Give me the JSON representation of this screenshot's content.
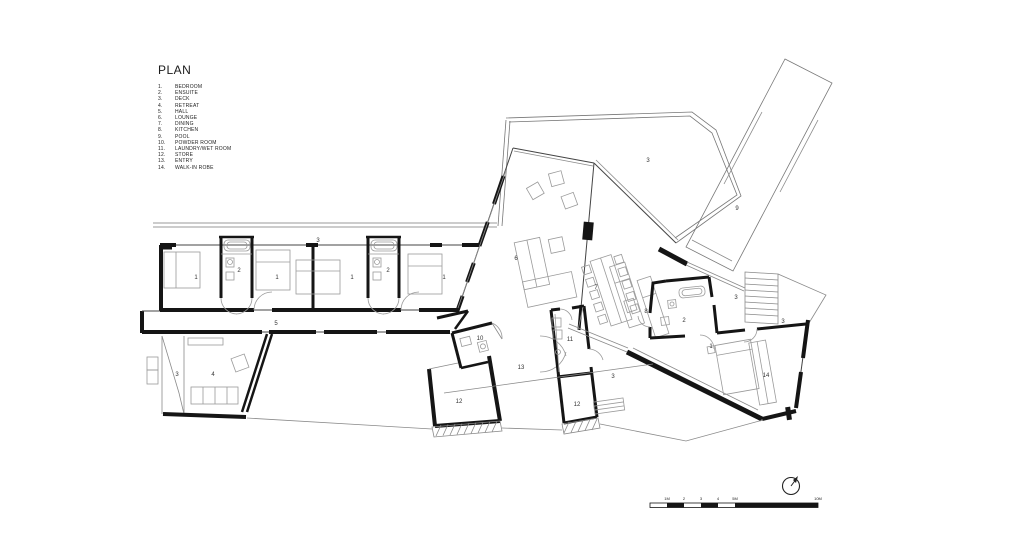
{
  "sheet": {
    "background": "#ffffff",
    "ink": "#1b1b1b",
    "thin_line": "#8a8a8a",
    "mid_line": "#555555"
  },
  "legend": {
    "title": "PLAN",
    "items": [
      {
        "num": "1.",
        "label": "BEDROOM"
      },
      {
        "num": "2.",
        "label": "ENSUITE"
      },
      {
        "num": "3.",
        "label": "DECK"
      },
      {
        "num": "4.",
        "label": "RETREAT"
      },
      {
        "num": "5.",
        "label": "HALL"
      },
      {
        "num": "6.",
        "label": "LOUNGE"
      },
      {
        "num": "7.",
        "label": "DINING"
      },
      {
        "num": "8.",
        "label": "KITCHEN"
      },
      {
        "num": "9.",
        "label": "POOL"
      },
      {
        "num": "10.",
        "label": "POWDER ROOM"
      },
      {
        "num": "11.",
        "label": "LAUNDRY/WET ROOM"
      },
      {
        "num": "12.",
        "label": "STORE"
      },
      {
        "num": "13.",
        "label": "ENTRY"
      },
      {
        "num": "14.",
        "label": "WALK-IN ROBE"
      }
    ]
  },
  "room_labels": [
    {
      "n": "1",
      "x": 196,
      "y": 279
    },
    {
      "n": "2",
      "x": 239,
      "y": 272
    },
    {
      "n": "1",
      "x": 277,
      "y": 279
    },
    {
      "n": "1",
      "x": 352,
      "y": 279
    },
    {
      "n": "2",
      "x": 388,
      "y": 272
    },
    {
      "n": "1",
      "x": 444,
      "y": 279
    },
    {
      "n": "3",
      "x": 318,
      "y": 242
    },
    {
      "n": "5",
      "x": 276,
      "y": 325
    },
    {
      "n": "3",
      "x": 177,
      "y": 376
    },
    {
      "n": "4",
      "x": 213,
      "y": 376
    },
    {
      "n": "6",
      "x": 516,
      "y": 260
    },
    {
      "n": "3",
      "x": 648,
      "y": 162
    },
    {
      "n": "9",
      "x": 737,
      "y": 210
    },
    {
      "n": "7",
      "x": 596,
      "y": 289
    },
    {
      "n": "8",
      "x": 646,
      "y": 313
    },
    {
      "n": "2",
      "x": 684,
      "y": 322
    },
    {
      "n": "1",
      "x": 711,
      "y": 348
    },
    {
      "n": "14",
      "x": 766,
      "y": 377
    },
    {
      "n": "3",
      "x": 736,
      "y": 299
    },
    {
      "n": "3",
      "x": 783,
      "y": 323
    },
    {
      "n": "10",
      "x": 480,
      "y": 340
    },
    {
      "n": "13",
      "x": 521,
      "y": 369
    },
    {
      "n": "11",
      "x": 570,
      "y": 341
    },
    {
      "n": "12",
      "x": 459,
      "y": 403
    },
    {
      "n": "12",
      "x": 577,
      "y": 406
    },
    {
      "n": "3",
      "x": 613,
      "y": 378
    }
  ],
  "scale_bar": {
    "labels": [
      {
        "text": "1M",
        "x": 667
      },
      {
        "text": "2",
        "x": 684
      },
      {
        "text": "3",
        "x": 701
      },
      {
        "text": "4",
        "x": 718
      },
      {
        "text": "5M",
        "x": 735
      },
      {
        "text": "10M",
        "x": 818
      }
    ]
  }
}
